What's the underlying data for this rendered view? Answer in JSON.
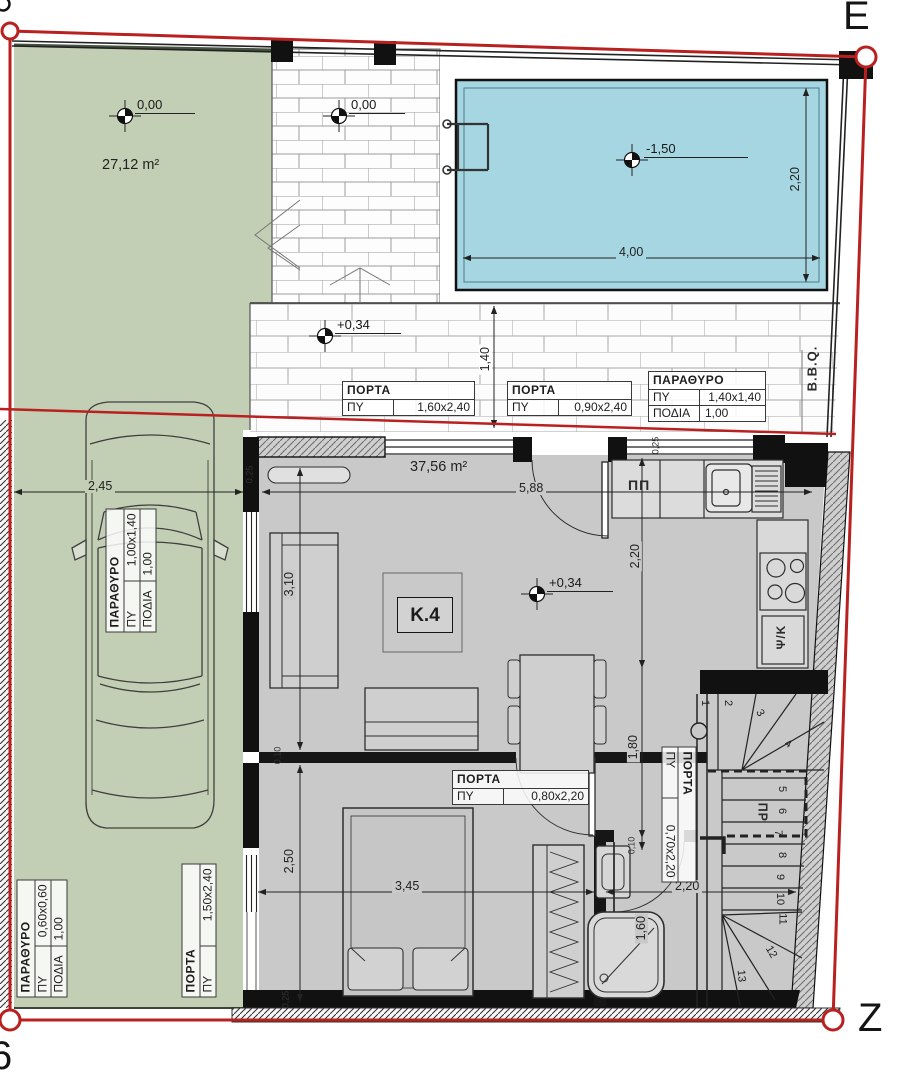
{
  "markers": {
    "top_right": "E",
    "bottom_right": "Z",
    "bottom_left": "6"
  },
  "areas": {
    "garden": "27,12 m²",
    "unit": "37,56 m²"
  },
  "unit_label": "K.4",
  "elevations": {
    "garden": "0,00",
    "patio": "0,00",
    "pool": "-1,50",
    "terrace": "+0,34",
    "living": "+0,34"
  },
  "annotations": {
    "bbq": "B.B.Q.",
    "dishwasher": "ΠΠ",
    "fridge": "Ψ/Κ",
    "stair_dir": "ΠΡ"
  },
  "dimensions": {
    "car_bay_width": "2,45",
    "living_width": "5,88",
    "pool_length": "4,00",
    "pool_width": "2,20",
    "terrace_depth": "1,40",
    "living_depth": "3,10",
    "kitchen_depth": "2,20",
    "hall_depth": "1,80",
    "bedroom_depth": "2,50",
    "bedroom_width": "3,45",
    "bath_width": "2,20",
    "shower_width": "1,60"
  },
  "small_dimensions": {
    "w1": "0,25",
    "w2": "0,10",
    "w3": "0,10",
    "w4": "0,25",
    "w5": "0,25"
  },
  "stairs": {
    "numbers": [
      "1",
      "2",
      "3",
      "4",
      "5",
      "6",
      "7",
      "8",
      "9",
      "10",
      "11",
      "12",
      "13"
    ]
  },
  "schedules": [
    {
      "title": "ΠΟΡΤΑ",
      "rows": [
        {
          "label": "ΠΥ",
          "value": "1,60x2,40"
        }
      ]
    },
    {
      "title": "ΠΟΡΤΑ",
      "rows": [
        {
          "label": "ΠΥ",
          "value": "0,90x2,40"
        }
      ]
    },
    {
      "title": "ΠΑΡΑΘΥΡΟ",
      "rows": [
        {
          "label": "ΠΥ",
          "value": "1,40x1,40"
        },
        {
          "label": "ΠΟΔΙΑ",
          "value": "1,00"
        }
      ]
    },
    {
      "title": "ΠΑΡΑΘΥΡΟ",
      "rows": [
        {
          "label": "ΠΥ",
          "value": "1,00x1,40"
        },
        {
          "label": "ΠΟΔΙΑ",
          "value": "1,00"
        }
      ]
    },
    {
      "title": "ΠΑΡΑΘΥΡΟ",
      "rows": [
        {
          "label": "ΠΥ",
          "value": "0,60x0,60"
        },
        {
          "label": "ΠΟΔΙΑ",
          "value": "1,00"
        }
      ]
    },
    {
      "title": "ΠΟΡΤΑ",
      "rows": [
        {
          "label": "ΠΥ",
          "value": "1,50x2,40"
        }
      ]
    },
    {
      "title": "ΠΟΡΤΑ",
      "rows": [
        {
          "label": "ΠΥ",
          "value": "0,80x2,20"
        }
      ]
    },
    {
      "title": "ΠΟΡΤΑ",
      "rows": [
        {
          "label": "ΠΥ",
          "value": "0,70x2,20"
        }
      ]
    }
  ],
  "colors": {
    "boundary_red": "#b8211f",
    "pool_water": "#a5d6e1",
    "garden_green": "#c3cfb5",
    "floor_gray": "#c9c9c9",
    "wall_black": "#111111"
  }
}
